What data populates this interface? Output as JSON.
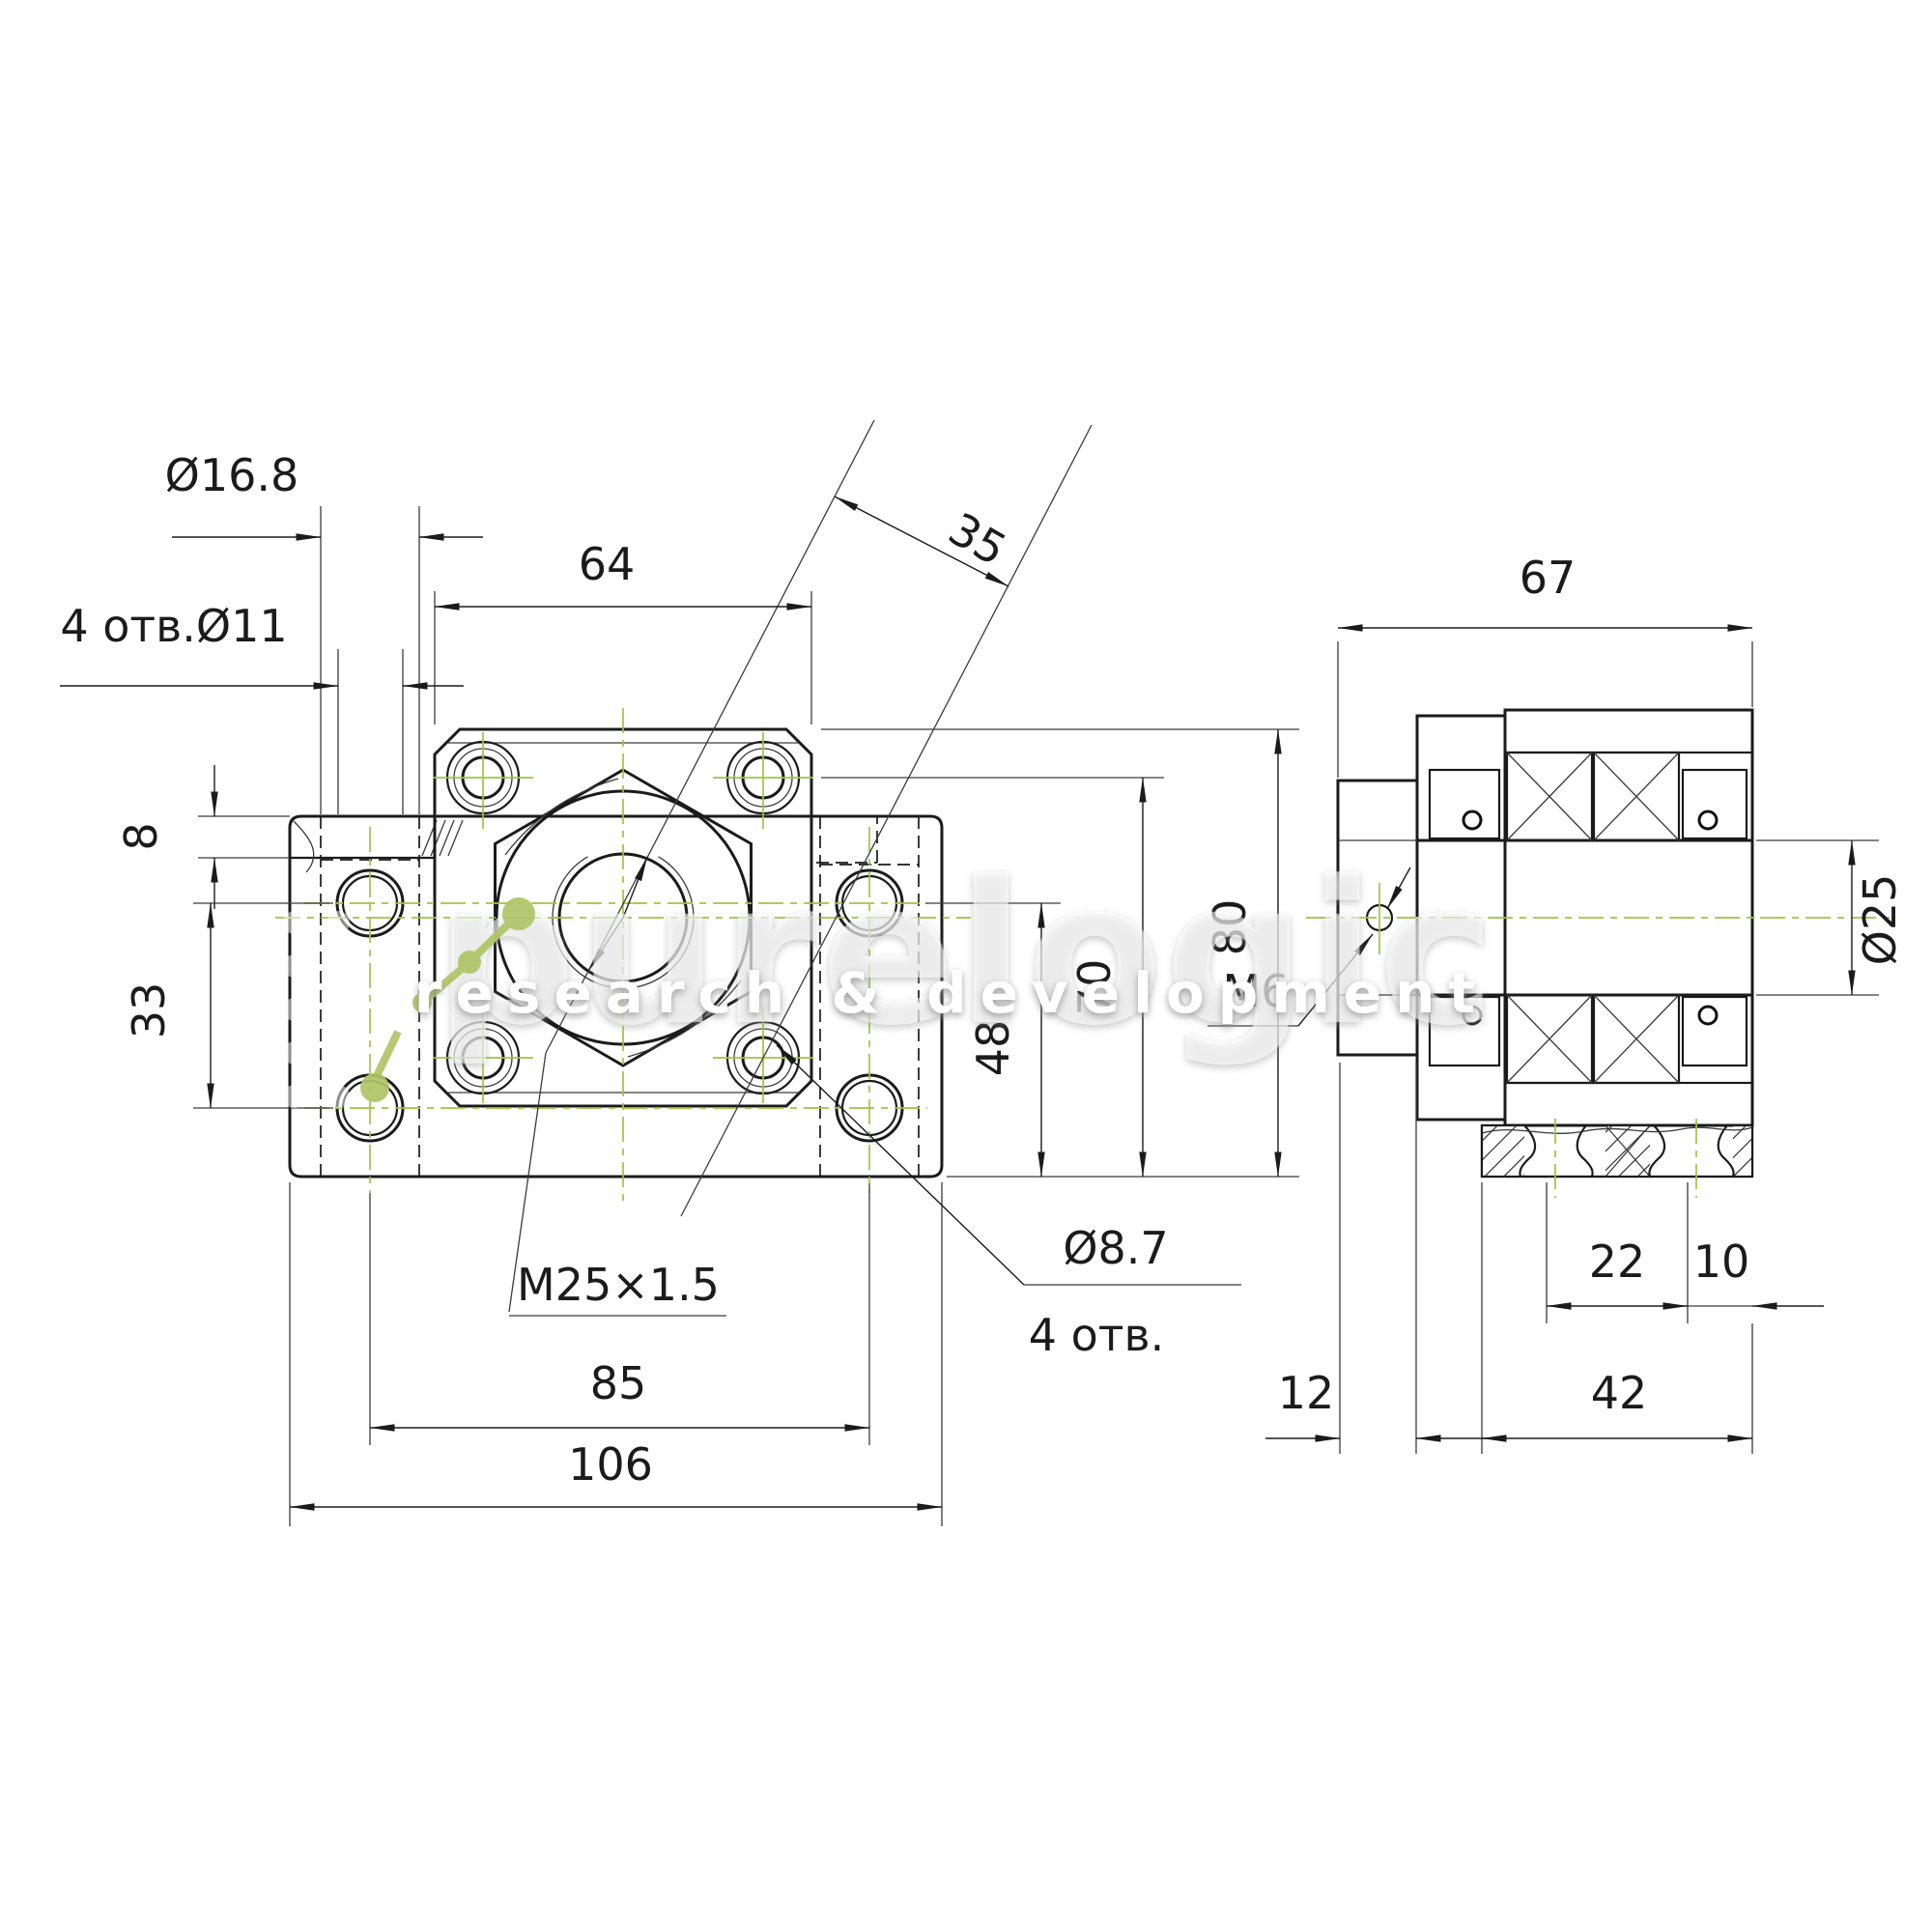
{
  "watermark": {
    "brand": "purelogic",
    "tagline": "research & development",
    "logo_icon": "molecule-dots-icon"
  },
  "colors": {
    "line": "#1b1b1b",
    "centerline_green": "#9dc63f",
    "watermark_green": "#aec566",
    "background": "#ffffff"
  },
  "front_view": {
    "dims": {
      "counterbore_dia": "Ø16.8",
      "mount_holes": "4 отв.Ø11",
      "flange_width": "64",
      "diag_offset": "35",
      "step_height": "8",
      "hole_row_spacing": "33",
      "hole_to_base": "48",
      "flange_hole_to_base": "70",
      "total_height": "80",
      "thread": "M25×1.5",
      "hole_col_spacing": "85",
      "base_width": "106",
      "flange_hole_dia": "Ø8.7",
      "flange_hole_count": "4 отв."
    }
  },
  "side_view": {
    "dims": {
      "total_depth": "67",
      "shaft_dia": "Ø25",
      "set_screw": "M6",
      "slot_spacing": "22",
      "slot_edge": "10",
      "locknut_width": "12",
      "base_depth": "42"
    }
  }
}
